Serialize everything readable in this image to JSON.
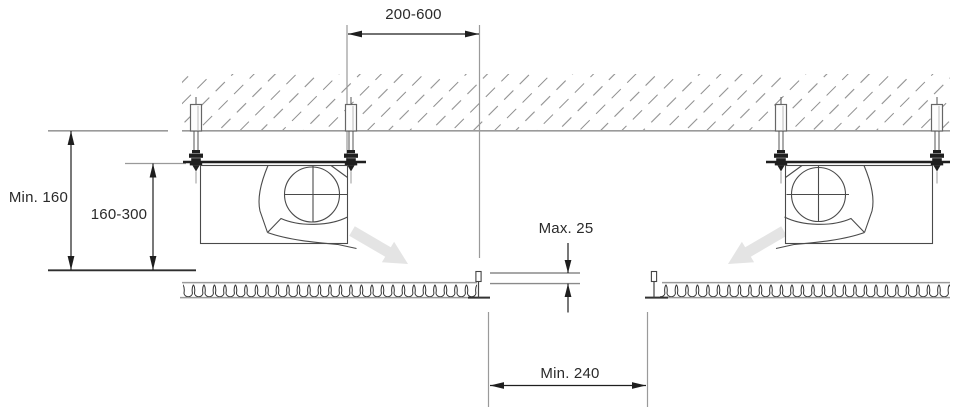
{
  "diagram": {
    "kind": "ceiling-fan-unit-installation-cross-section",
    "labels": {
      "hanger_spacing": "200-600",
      "ceiling_void_min": "Min. 160",
      "suspension_height_range": "160-300",
      "panel_lip_max": "Max. 25",
      "opening_min_width": "Min. 240"
    },
    "colors": {
      "drawing_line": "#4a4a4a",
      "dimension_line": "#1e1e1e",
      "extension_line": "#9a9a9a",
      "hatch": "#8f8f8f",
      "insulation_loops": "#2f2f2f",
      "airflow_arrow_fill": "#e4e4e4",
      "label_text": "#2a2a2a",
      "background": "#ffffff"
    }
  }
}
